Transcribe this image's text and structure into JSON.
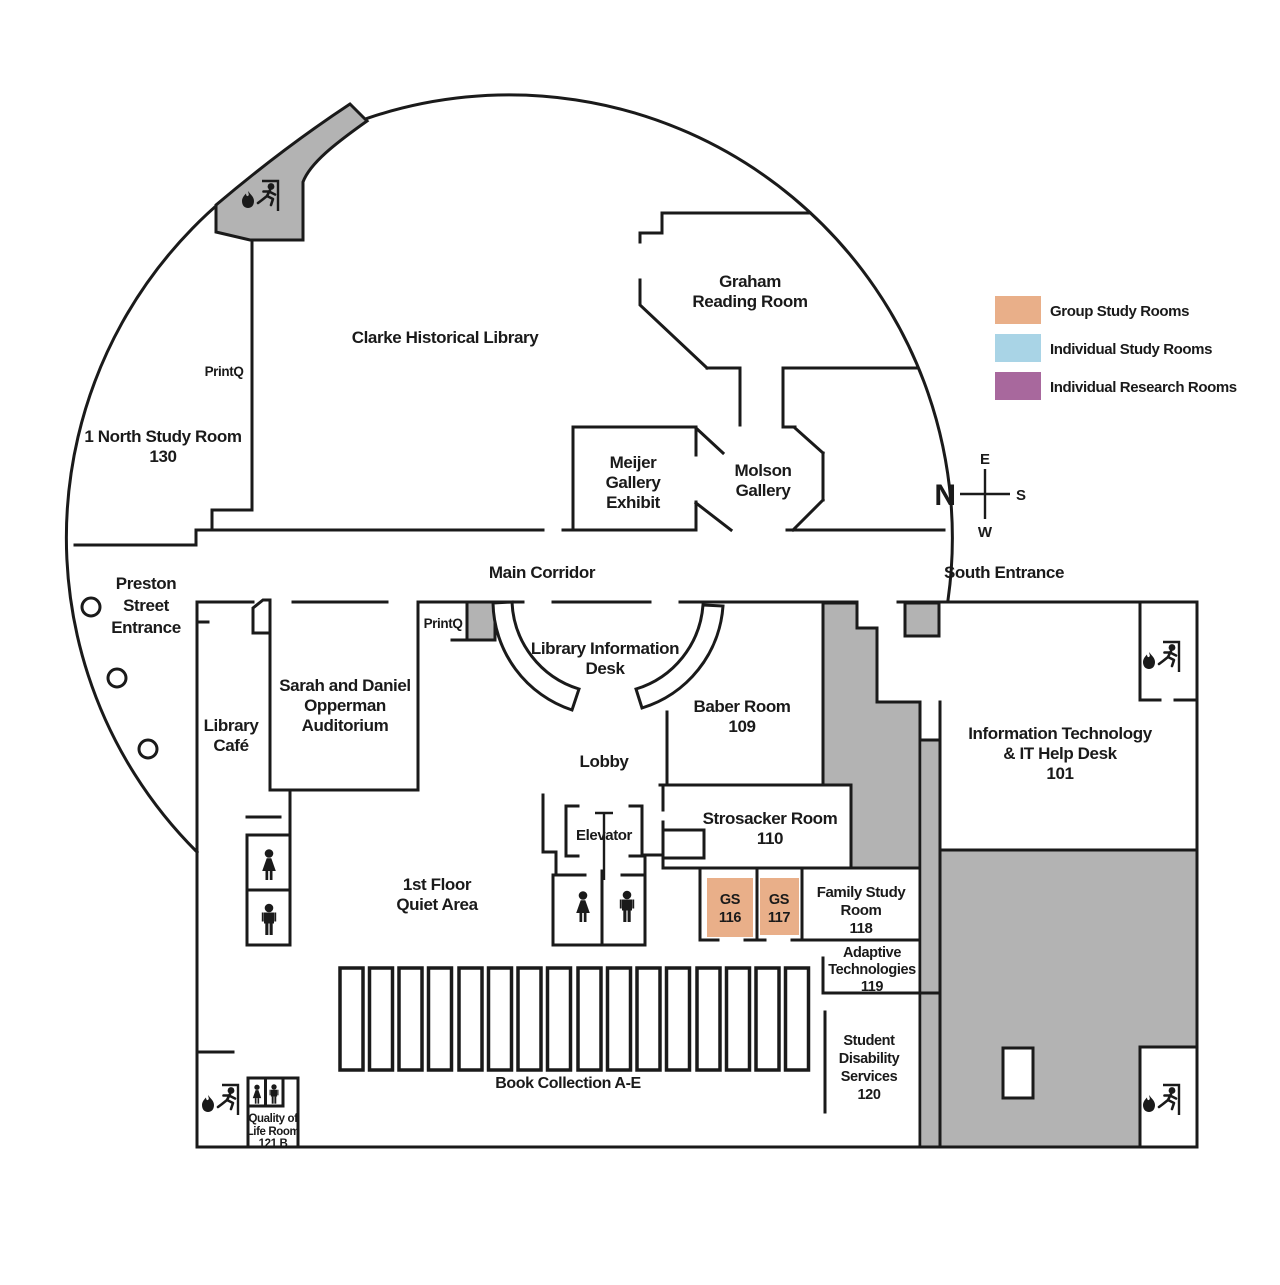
{
  "legend": {
    "items": [
      {
        "label": "Group Study Rooms",
        "color": "#E9AF89"
      },
      {
        "label": "Individual Study Rooms",
        "color": "#A9D4E6"
      },
      {
        "label": "Individual Research Rooms",
        "color": "#A8689D"
      }
    ]
  },
  "compass": {
    "north": "N",
    "east": "E",
    "south": "S",
    "west": "W"
  },
  "colors": {
    "wall": "#1a1a1a",
    "shaded_area": "#b3b3b3",
    "group_study": "#E9AF89"
  },
  "icons": {
    "fire_exit": "flame + running person + door frame",
    "restroom_woman": "woman pictogram",
    "restroom_man": "man pictogram",
    "pillar": "circle",
    "elevator_symbol": "T"
  },
  "rooms": {
    "clarke": {
      "lines": [
        "Clarke Historical Library"
      ]
    },
    "graham": {
      "lines": [
        "Graham",
        "Reading Room"
      ]
    },
    "north_study": {
      "lines": [
        "1 North Study Room",
        "130"
      ]
    },
    "printq_upper": {
      "lines": [
        "PrintQ"
      ]
    },
    "meijer": {
      "lines": [
        "Meijer",
        "Gallery",
        "Exhibit"
      ]
    },
    "molson": {
      "lines": [
        "Molson",
        "Gallery"
      ]
    },
    "preston": {
      "lines": [
        "Preston",
        "Street",
        "Entrance"
      ]
    },
    "main_corridor": {
      "lines": [
        "Main Corridor"
      ]
    },
    "south_entrance": {
      "lines": [
        "South Entrance"
      ]
    },
    "library_cafe": {
      "lines": [
        "Library",
        "Café"
      ]
    },
    "opperman": {
      "lines": [
        "Sarah and Daniel",
        "Opperman",
        "Auditorium"
      ]
    },
    "printq_lower": {
      "lines": [
        "PrintQ"
      ]
    },
    "info_desk": {
      "lines": [
        "Library Information",
        "Desk"
      ]
    },
    "baber": {
      "lines": [
        "Baber Room",
        "109"
      ]
    },
    "it": {
      "lines": [
        "Information Technology",
        "& IT Help Desk",
        "101"
      ]
    },
    "lobby": {
      "lines": [
        "Lobby"
      ]
    },
    "elevator": {
      "lines": [
        "Elevator"
      ]
    },
    "strosacker": {
      "lines": [
        "Strosacker Room",
        "110"
      ]
    },
    "quiet": {
      "lines": [
        "1st Floor",
        "Quiet Area"
      ]
    },
    "gs116": {
      "lines": [
        "GS",
        "116"
      ]
    },
    "gs117": {
      "lines": [
        "GS",
        "117"
      ]
    },
    "family": {
      "lines": [
        "Family Study",
        "Room",
        "118"
      ]
    },
    "adaptive": {
      "lines": [
        "Adaptive",
        "Technologies",
        "119"
      ]
    },
    "disability": {
      "lines": [
        "Student",
        "Disability",
        "Services",
        "120"
      ]
    },
    "books": {
      "lines": [
        "Book Collection A-E"
      ]
    },
    "quality": {
      "lines": [
        "Quality of",
        "Life Room",
        "121 B"
      ]
    }
  },
  "book_stacks": {
    "group_count": 4,
    "stacks_per_group": 4
  }
}
